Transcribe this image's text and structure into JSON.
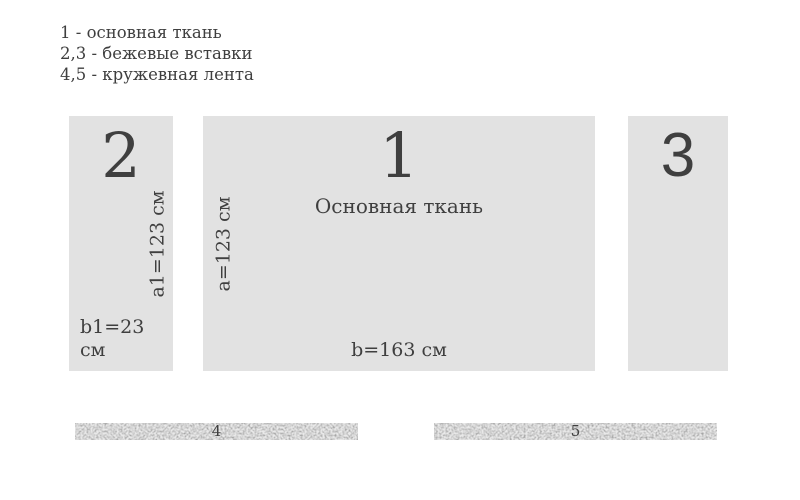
{
  "colors": {
    "background": "#ffffff",
    "piece_fill": "#e2e2e2",
    "text": "#3f3f3f",
    "ribbon_base": "#e9e9e9",
    "ribbon_speckle": "#9e9e9e"
  },
  "legend": {
    "lines": [
      "1 - основная ткань",
      "2,3 - бежевые вставки",
      "4,5 - кружевная лента"
    ]
  },
  "pieces": {
    "main_fabric": {
      "number": "1",
      "title": "Основная ткань",
      "height_label": "a=123 см",
      "width_label": "b=163 см"
    },
    "insert_left": {
      "number": "2",
      "height_label": "a1=123 см",
      "width_label": "b1=23 см"
    },
    "insert_right": {
      "number": "3"
    }
  },
  "ribbons": {
    "left": {
      "number": "4"
    },
    "right": {
      "number": "5"
    }
  }
}
